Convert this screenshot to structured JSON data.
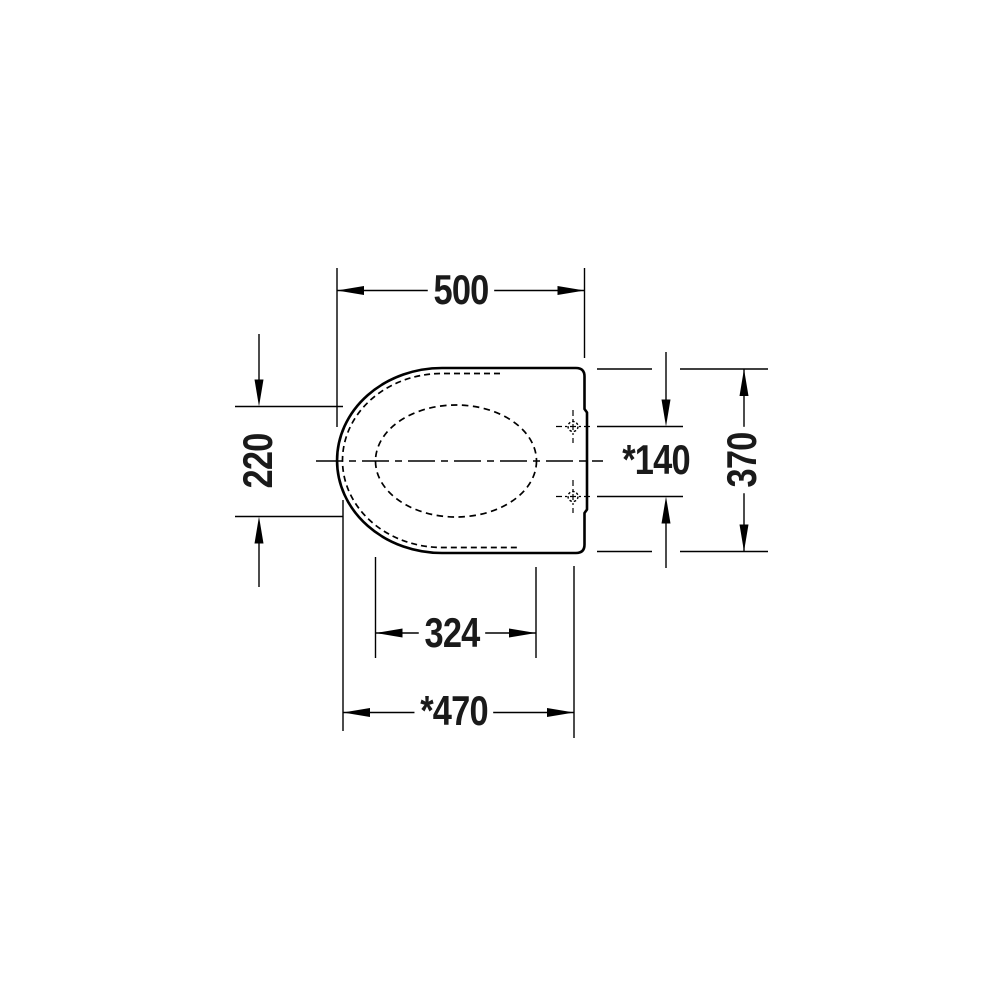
{
  "drawing": {
    "background_color": "#ffffff",
    "line_color": "#000000",
    "text_color": "#1a1a1a",
    "dimensions": {
      "overall_length_top": {
        "label": "500"
      },
      "front_section_height": {
        "label": "220"
      },
      "hinge_hole_spacing": {
        "label": "*140"
      },
      "overall_width_right": {
        "label": "370"
      },
      "opening_length": {
        "label": "324"
      },
      "front_to_hinge_depth": {
        "label": "*470"
      }
    }
  }
}
